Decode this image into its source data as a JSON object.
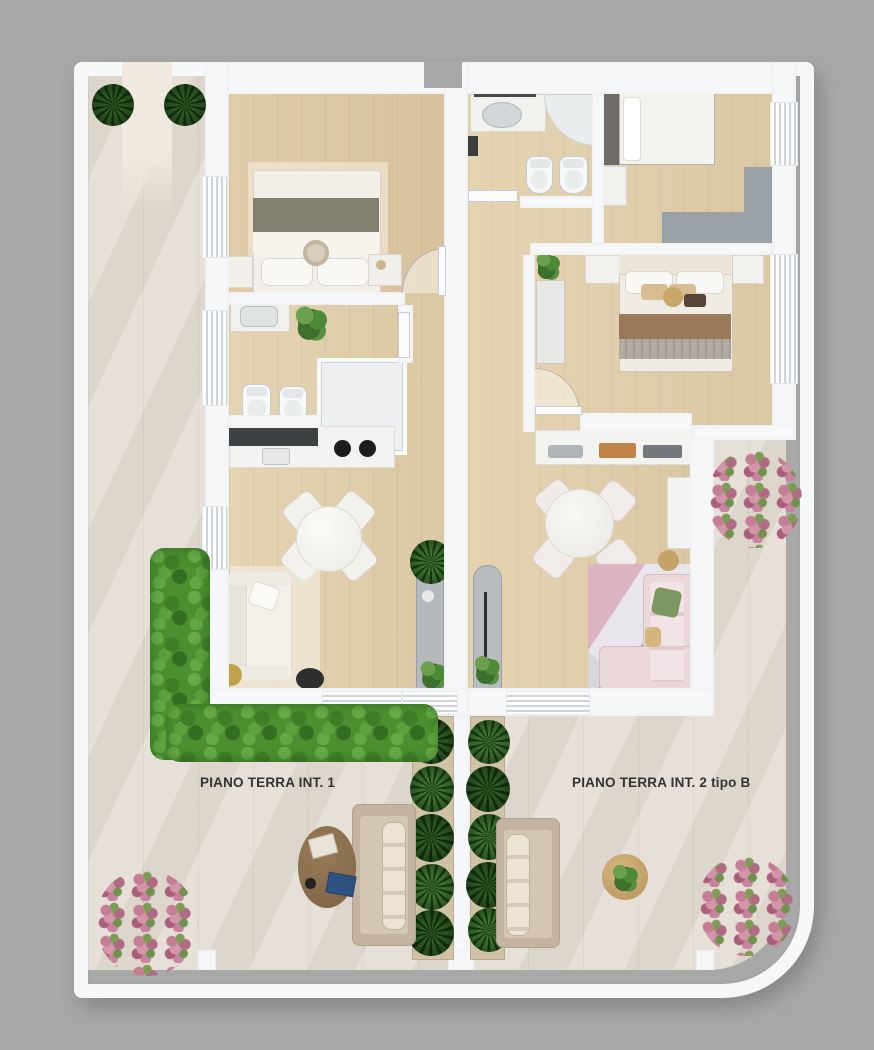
{
  "plan": {
    "type": "residential-floor-plan-3d-render",
    "labels": {
      "unit1": "PIANO TERRA INT. 1",
      "unit2": "PIANO TERRA INT. 2 tipo B"
    }
  },
  "colors": {
    "bg": "#a8a8a8",
    "wall": "#f6f7f9",
    "tile": "#e4ded5",
    "wood": "#e2cfaa",
    "grass": "#4c8f31",
    "plant_dark": "#27511e",
    "flower_pink": "#c47e95",
    "label_text": "#333333"
  }
}
